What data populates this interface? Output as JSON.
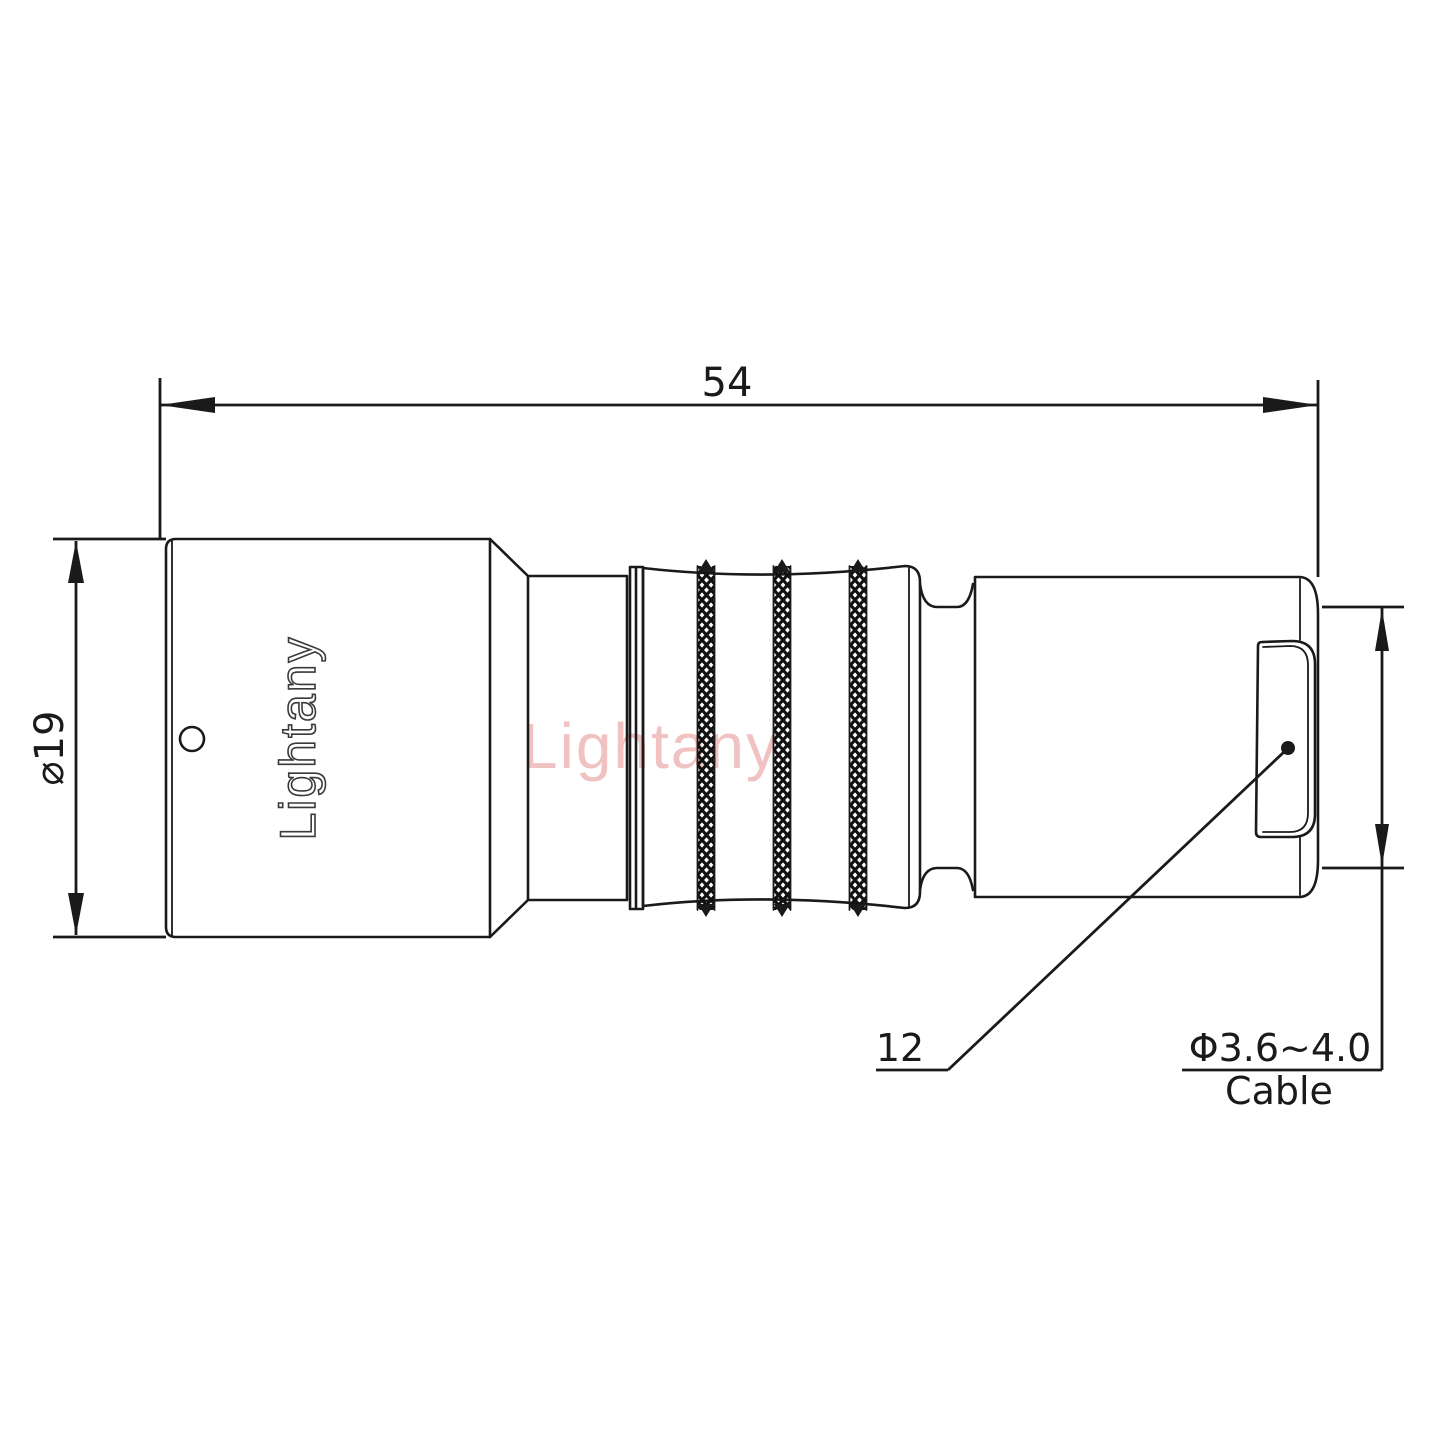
{
  "drawing": {
    "title_watermark": "Lightany",
    "body_logo": "Lightany",
    "dimensions": {
      "overall_length": "54",
      "front_diameter": "⌀19",
      "rear_ref": "12",
      "cable_range": "Φ3.6~4.0",
      "cable_label": "Cable"
    },
    "colors": {
      "line": "#1a1a1a",
      "watermark_pink": "#f1c2c2",
      "logo_outline": "#3a3a3a",
      "background": "#ffffff"
    }
  }
}
